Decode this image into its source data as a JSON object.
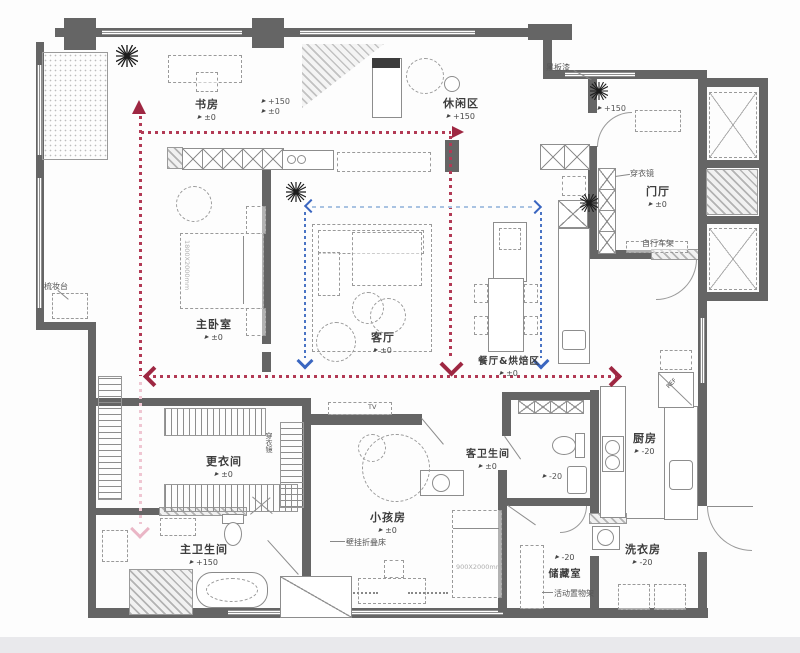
{
  "plan": {
    "rooms": [
      {
        "name": "书房",
        "level": "±0"
      },
      {
        "name": "休闲区",
        "level": "+150"
      },
      {
        "name": "门厅",
        "level": "±0"
      },
      {
        "name": "主卧室",
        "level": "±0"
      },
      {
        "name": "客厅",
        "level": "±0"
      },
      {
        "name": "餐厅&烘焙区",
        "level": "±0"
      },
      {
        "name": "厨房",
        "level": "-20"
      },
      {
        "name": "洗衣房",
        "level": "-20"
      },
      {
        "name": "储藏室",
        "level": "-20"
      },
      {
        "name": "客卫生间",
        "level": "±0"
      },
      {
        "name": "小孩房",
        "level": "±0"
      },
      {
        "name": "更衣间",
        "level": "±0"
      },
      {
        "name": "主卫生间",
        "level": "+150"
      }
    ],
    "annotations": {
      "blackboard_paint": "黑板漆",
      "foyer_mirror": "穿衣镜",
      "bike_rack": "自行车架",
      "vanity_table": "梳妆台",
      "closet_mirror": "穿衣镜",
      "wall_folding_bed": "壁挂折叠床",
      "movable_shelf": "活动置物架",
      "fridge": "REF",
      "tv": "TV"
    },
    "markers": {
      "step_up": "+150",
      "step_zero": "±0",
      "wet_area": "-20"
    },
    "dimensions": {
      "master_bed": "1800X2000mm",
      "kids_bed": "900X2000mm"
    },
    "colors": {
      "wall": "#656565",
      "path_red": "#b23a55",
      "path_blue": "#3a66c0",
      "path_blue_light": "#a9c3e2",
      "path_pink": "#efc6d2"
    }
  }
}
